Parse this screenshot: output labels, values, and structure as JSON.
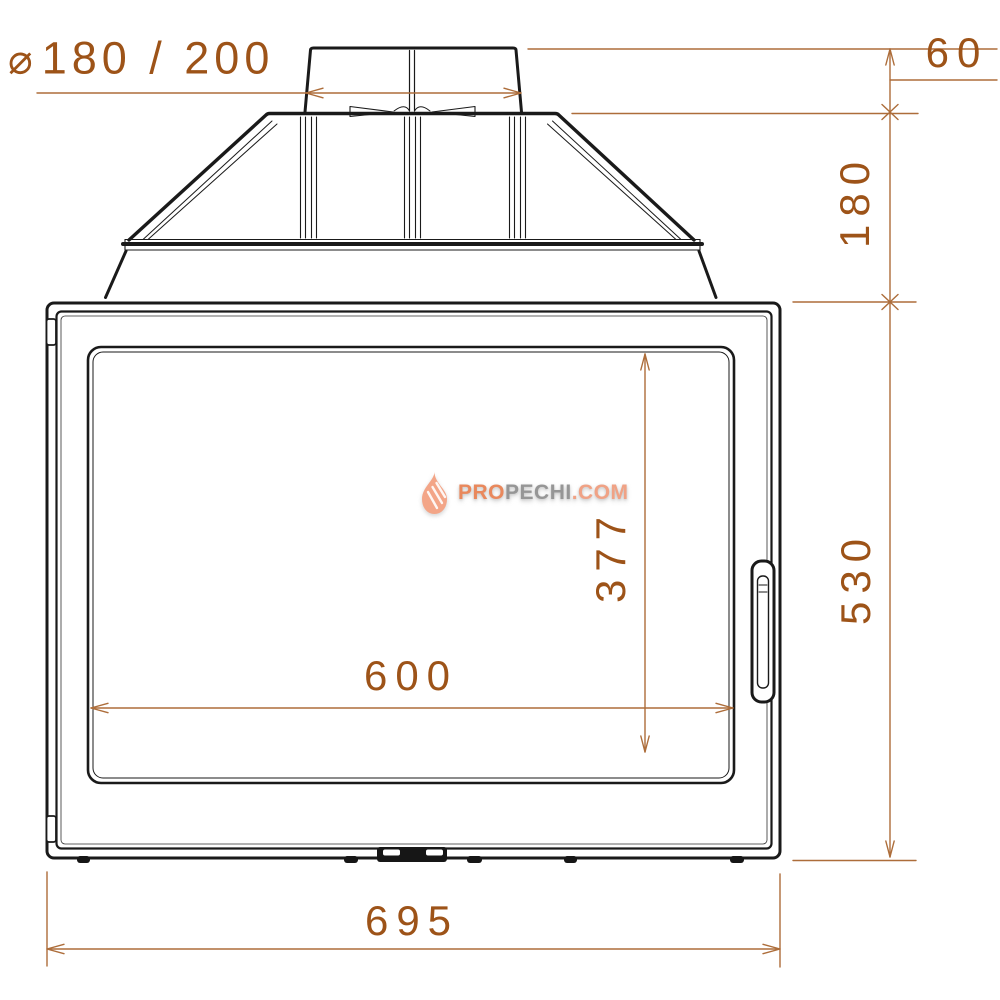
{
  "page": {
    "background": "#ffffff"
  },
  "drawing": {
    "title": "fireplace insert front view technical drawing",
    "outline_color": "#1a1a1a",
    "dimension_line_color": "#ad6d3a",
    "dimension_text_color": "#9d5318",
    "dimensions": {
      "flue_diameter": {
        "symbol": "⌀",
        "value": "180 / 200"
      },
      "collar_height": "60",
      "hood_height": "180",
      "body_height": "530",
      "glass_width": "600",
      "glass_height": "377",
      "overall_width": "695"
    }
  },
  "watermark": {
    "brand_pro": "PRO",
    "brand_pechi": "PECHI",
    "brand_domain": ".COM",
    "flame_color": "#f3a587",
    "pro_color": "#e9885c",
    "pechi_color": "#969696",
    "domain_color": "#f0a285"
  }
}
